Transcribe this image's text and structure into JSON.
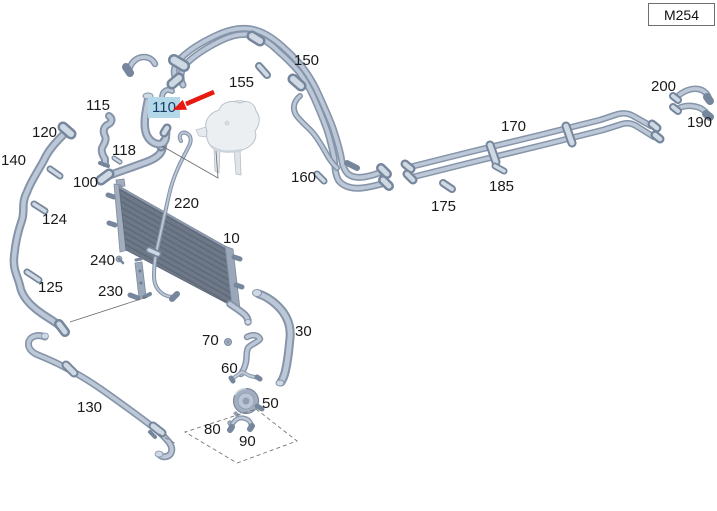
{
  "window": {
    "model_code": "M254"
  },
  "diagram": {
    "highlighted_part": "110",
    "highlight_bg": "#b3d9e8",
    "highlight_text": "#173f66",
    "arrow_color": "#e8190f",
    "label_color": "#1a1a1a",
    "highlighted_label": {
      "text": "110",
      "x": 148,
      "y": 97,
      "w": 32,
      "h": 21
    },
    "labels": [
      {
        "text": "150",
        "x": 294,
        "y": 53
      },
      {
        "text": "155",
        "x": 229,
        "y": 75
      },
      {
        "text": "115",
        "x": 86,
        "y": 98
      },
      {
        "text": "120",
        "x": 32,
        "y": 125
      },
      {
        "text": "140",
        "x": 1,
        "y": 153
      },
      {
        "text": "118",
        "x": 112,
        "y": 143
      },
      {
        "text": "100",
        "x": 73,
        "y": 175
      },
      {
        "text": "160",
        "x": 291,
        "y": 170
      },
      {
        "text": "220",
        "x": 174,
        "y": 196
      },
      {
        "text": "10",
        "x": 223,
        "y": 231
      },
      {
        "text": "124",
        "x": 42,
        "y": 212
      },
      {
        "text": "240",
        "x": 90,
        "y": 253
      },
      {
        "text": "230",
        "x": 98,
        "y": 284
      },
      {
        "text": "125",
        "x": 38,
        "y": 280
      },
      {
        "text": "170",
        "x": 501,
        "y": 119
      },
      {
        "text": "200",
        "x": 651,
        "y": 79
      },
      {
        "text": "190",
        "x": 687,
        "y": 115
      },
      {
        "text": "185",
        "x": 489,
        "y": 179
      },
      {
        "text": "175",
        "x": 431,
        "y": 199
      },
      {
        "text": "70",
        "x": 202,
        "y": 333
      },
      {
        "text": "30",
        "x": 295,
        "y": 324
      },
      {
        "text": "60",
        "x": 221,
        "y": 361
      },
      {
        "text": "50",
        "x": 262,
        "y": 396
      },
      {
        "text": "80",
        "x": 204,
        "y": 422
      },
      {
        "text": "90",
        "x": 239,
        "y": 434
      },
      {
        "text": "130",
        "x": 77,
        "y": 400
      }
    ]
  }
}
